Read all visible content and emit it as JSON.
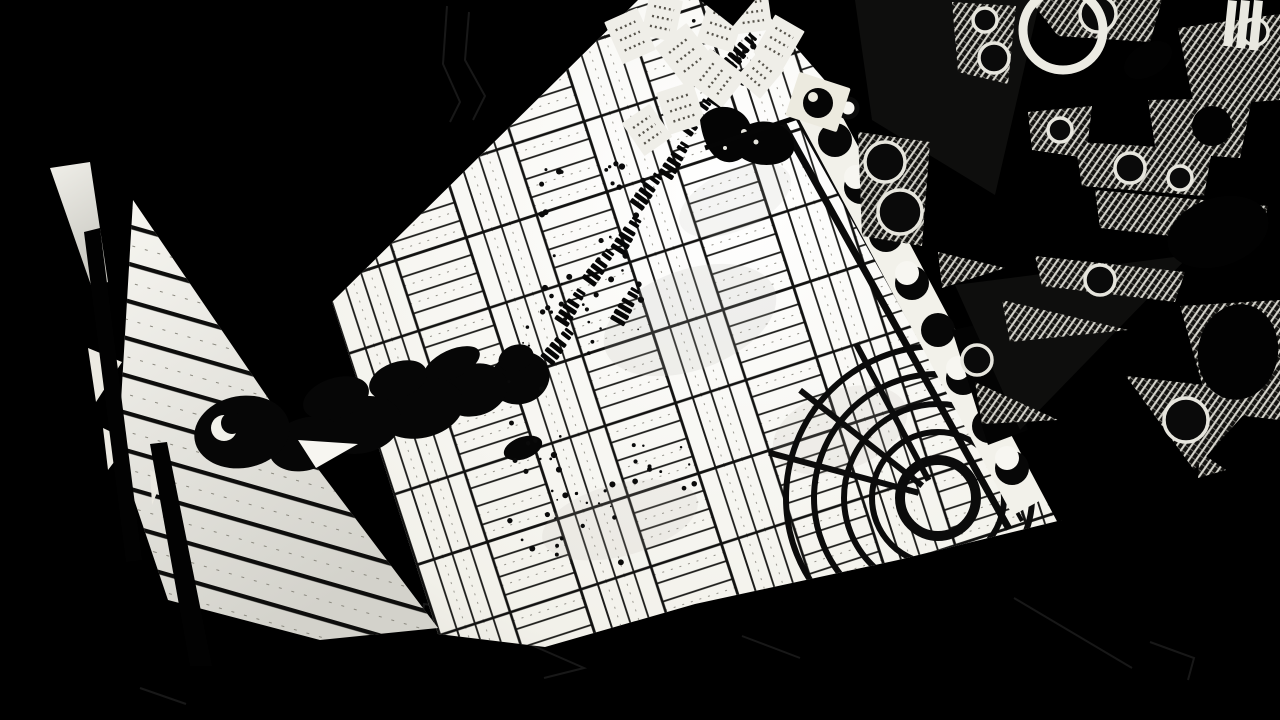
{
  "scene": {
    "palette": {
      "background": "#000000",
      "floor": "#f7f6f1",
      "floor_dim": "#e3e1d9",
      "wedge_top": "#f4f3ee",
      "wedge_bottom": "#d7d6cf",
      "plank_line": "#141412",
      "ink": "#060606",
      "paper": "#efeee8",
      "paper_text": "#57544c",
      "hatch_light": "#d8d7cf",
      "hatch_base": "#12110f",
      "ring_stroke": "#e6e5dd",
      "faint_outline": "#181818"
    },
    "character": {
      "label": "man-in-hat-top-down-silhouette",
      "blobs": [
        [
          520,
          378,
          30,
          26,
          -20
        ],
        [
          516,
          358,
          18,
          13,
          -20
        ],
        [
          474,
          390,
          34,
          26,
          -15
        ],
        [
          452,
          364,
          30,
          14,
          -25
        ],
        [
          420,
          408,
          44,
          30,
          -12
        ],
        [
          362,
          425,
          40,
          28,
          -15
        ],
        [
          306,
          444,
          38,
          26,
          -18
        ],
        [
          242,
          432,
          48,
          36,
          -10
        ],
        [
          523,
          448,
          20,
          11,
          -20
        ],
        [
          398,
          380,
          30,
          18,
          -20
        ],
        [
          336,
          398,
          34,
          20,
          -18
        ]
      ],
      "crescent": {
        "cx": 224,
        "cy": 428,
        "r_outer": 13,
        "offset_x": 8,
        "offset_y": -5,
        "r_inner": 11
      },
      "notch": "298,440 358,444 316,468"
    },
    "papers": [
      {
        "cx": 630,
        "cy": 36,
        "w": 36,
        "h": 46,
        "rot": -24
      },
      {
        "cx": 662,
        "cy": 18,
        "w": 34,
        "h": 42,
        "rot": 12
      },
      {
        "cx": 686,
        "cy": 55,
        "w": 40,
        "h": 50,
        "rot": -38
      },
      {
        "cx": 721,
        "cy": 26,
        "w": 38,
        "h": 44,
        "rot": 18
      },
      {
        "cx": 752,
        "cy": 12,
        "w": 36,
        "h": 40,
        "rot": -8
      },
      {
        "cx": 779,
        "cy": 42,
        "w": 34,
        "h": 44,
        "rot": 30
      },
      {
        "cx": 716,
        "cy": 78,
        "w": 40,
        "h": 46,
        "rot": -52
      },
      {
        "cx": 681,
        "cy": 108,
        "w": 38,
        "h": 44,
        "rot": -18
      },
      {
        "cx": 647,
        "cy": 130,
        "w": 34,
        "h": 40,
        "rot": -35
      },
      {
        "cx": 760,
        "cy": 74,
        "w": 32,
        "h": 38,
        "rot": 40
      }
    ],
    "footprints": [
      [
        573,
        306,
        -57
      ],
      [
        601,
        266,
        -54
      ],
      [
        629,
        234,
        -58
      ],
      [
        649,
        190,
        -54
      ],
      [
        677,
        159,
        -58
      ],
      [
        698,
        116,
        -54
      ],
      [
        725,
        87,
        -58
      ],
      [
        743,
        50,
        -50
      ],
      [
        628,
        305,
        -60
      ],
      [
        560,
        345,
        -52
      ]
    ],
    "speck_clusters": [
      {
        "cx": 595,
        "cy": 245,
        "rx": 55,
        "ry": 85,
        "n": 30
      },
      {
        "cx": 562,
        "cy": 320,
        "rx": 42,
        "ry": 34,
        "n": 14
      },
      {
        "cx": 580,
        "cy": 515,
        "rx": 72,
        "ry": 55,
        "n": 24
      },
      {
        "cx": 662,
        "cy": 468,
        "rx": 36,
        "ry": 26,
        "n": 10
      },
      {
        "cx": 733,
        "cy": 52,
        "rx": 46,
        "ry": 36,
        "n": 16
      },
      {
        "cx": 816,
        "cy": 112,
        "rx": 26,
        "ry": 20,
        "n": 9
      },
      {
        "cx": 538,
        "cy": 420,
        "rx": 30,
        "ry": 40,
        "n": 10
      }
    ],
    "band": {
      "items": [
        [
          835,
          140,
          "circle"
        ],
        [
          861,
          187,
          "crescent"
        ],
        [
          886,
          235,
          "circle"
        ],
        [
          912,
          283,
          "crescent"
        ],
        [
          938,
          330,
          "circle"
        ],
        [
          963,
          378,
          "crescent"
        ],
        [
          989,
          426,
          "circle"
        ],
        [
          1012,
          468,
          "crescent"
        ],
        [
          848,
          108,
          "ring"
        ]
      ],
      "radius": 17
    },
    "ornament": {
      "patches": [
        "952,2 1016,6 1008,84 958,72",
        "1030,0 1162,0 1150,42 1058,36",
        "1178,28 1280,14 1280,100 1194,106",
        "1028,112 1092,106 1086,158 1032,150",
        "1148,100 1252,98 1240,158 1156,152",
        "1075,142 1212,150 1204,196 1082,186",
        "1095,190 1268,206 1258,246 1100,228",
        "1035,256 1185,272 1175,302 1042,286",
        "1180,306 1280,300 1280,420 1210,412",
        "858,132 930,142 922,246 862,236",
        "1126,376 1264,392 1194,470",
        "1200,452 1226,470 1198,478",
        "938,252 1005,268 942,288",
        "1002,300 1128,330 1010,342",
        "975,382 1058,420 982,424"
      ],
      "rings": [
        [
          985,
          20,
          12
        ],
        [
          994,
          58,
          15
        ],
        [
          1098,
          14,
          18
        ],
        [
          1255,
          32,
          13
        ],
        [
          885,
          162,
          20
        ],
        [
          900,
          212,
          22
        ],
        [
          1130,
          168,
          15
        ],
        [
          1180,
          178,
          12
        ],
        [
          1100,
          280,
          15
        ],
        [
          1186,
          420,
          22
        ],
        [
          977,
          360,
          15
        ],
        [
          1060,
          130,
          12
        ]
      ],
      "black_ellipses": [
        [
          1218,
          232,
          52,
          34,
          -18
        ],
        [
          1238,
          352,
          40,
          48,
          10
        ],
        [
          1212,
          126,
          20,
          20,
          0
        ],
        [
          1148,
          60,
          26,
          16,
          -30
        ]
      ],
      "white_bars": [
        [
          1228,
          0,
          9,
          46,
          6
        ],
        [
          1241,
          0,
          9,
          48,
          6
        ],
        [
          1254,
          0,
          9,
          50,
          6
        ]
      ],
      "big_ring": {
        "cx": 1063,
        "cy": 30,
        "r": 40
      },
      "sheen": [
        "855,0 1040,0 995,195 872,120",
        "955,285 1190,255 1020,430"
      ]
    },
    "corner_inlay": {
      "cx": 938,
      "cy": 498,
      "radii": [
        38,
        66,
        94,
        124,
        152
      ],
      "spoke_angles": [
        195,
        218,
        242
      ]
    },
    "white_slivers": [
      "88,348 122,362 96,402",
      "103,428 130,441 108,470",
      "150,470 163,478 152,505"
    ],
    "post_shadows": [
      "150,444 167,442 212,666 190,666",
      "84,232 100,228 142,560 126,562"
    ],
    "faint_outlines": [
      "M447,6 L443,64 L460,102 L450,122",
      "M469,12 L465,60 L485,96 L473,120",
      "M424,604 l46,6 l-2,14 l-46,-6 Z",
      "M536,604 a6,6 0 1 0 0.2,0",
      "M536,616 l-4,14",
      "M520,640 l64,28 l-40,10",
      "M742,636 l58,22",
      "M1014,598 l118,70",
      "M1150,642 l44,16 l-6,22",
      "M140,688 l46,16"
    ],
    "bird_specks": [
      [
        744,
        132,
        3
      ],
      [
        756,
        142,
        2.5
      ],
      [
        725,
        148,
        2
      ]
    ]
  }
}
